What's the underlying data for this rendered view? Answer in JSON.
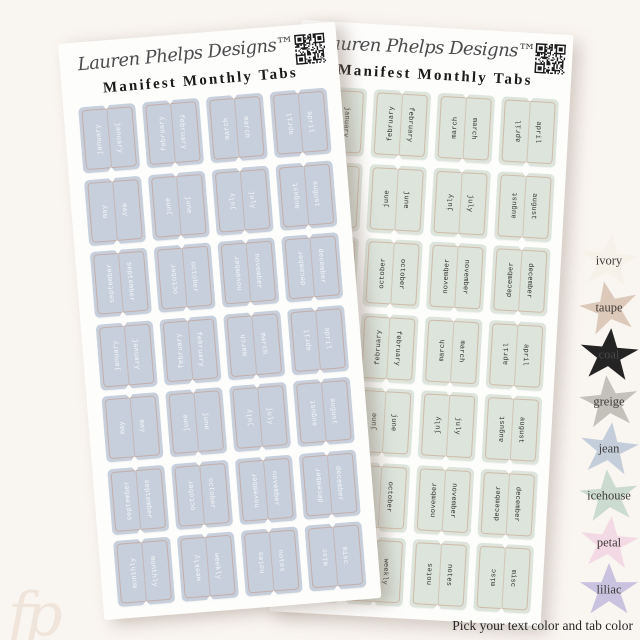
{
  "page": {
    "caption": "Pick your text color and tab color",
    "watermark": "fp",
    "background_color": "#f9f5f1"
  },
  "sheets": {
    "left": {
      "brand": "Lauren Phelps Designs™",
      "title": "Manifest Monthly Tabs",
      "qr_icon": "qr-code",
      "tab_fill": "#c8cfdc",
      "tab_text": "#f5f6f9",
      "labels": [
        "january",
        "february",
        "march",
        "april",
        "may",
        "june",
        "july",
        "august",
        "september",
        "october",
        "november",
        "december",
        "january",
        "february",
        "march",
        "april",
        "may",
        "june",
        "july",
        "august",
        "september",
        "october",
        "november",
        "december",
        "monthly",
        "weekly",
        "notes",
        "misc"
      ]
    },
    "right": {
      "brand": "Lauren Phelps Designs™",
      "title": "Manifest Monthly Tabs",
      "qr_icon": "qr-code",
      "tab_fill": "#dce4db",
      "tab_text": "#33332e",
      "labels": [
        "january",
        "february",
        "march",
        "april",
        "may",
        "june",
        "july",
        "august",
        "september",
        "october",
        "november",
        "december",
        "january",
        "february",
        "march",
        "april",
        "may",
        "june",
        "july",
        "august",
        "september",
        "october",
        "november",
        "december",
        "monthly",
        "weekly",
        "notes",
        "misc"
      ]
    }
  },
  "swatches": {
    "items": [
      {
        "name": "ivory",
        "color": "#f6f1e9"
      },
      {
        "name": "taupe",
        "color": "#dcc9b9"
      },
      {
        "name": "coal",
        "color": "#242424",
        "label_color": "#4a4a4a"
      },
      {
        "name": "greige",
        "color": "#c4c0ba"
      },
      {
        "name": "jean",
        "color": "#c4cedb"
      },
      {
        "name": "icehouse",
        "color": "#cbdbce"
      },
      {
        "name": "petal",
        "color": "#f3d9e4"
      },
      {
        "name": "liliac",
        "color": "#c9c3df"
      }
    ]
  }
}
